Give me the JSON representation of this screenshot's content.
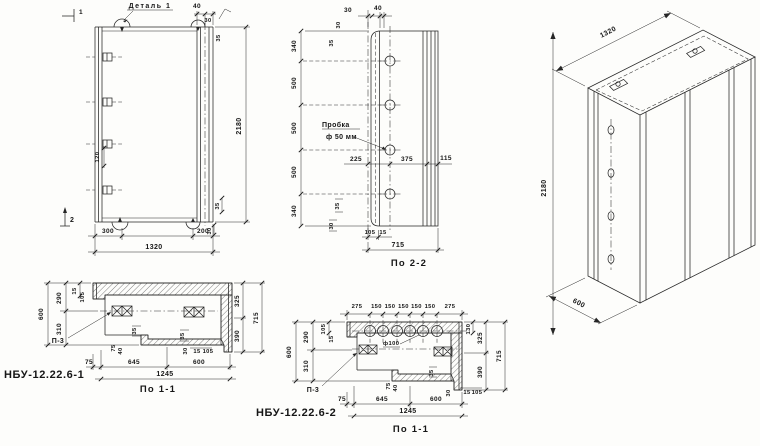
{
  "front_view": {
    "detail_label": "Деталь 1",
    "marker_1": "1",
    "marker_2": "2",
    "dims": {
      "top_40": "40",
      "top_30": "30",
      "top_35": "35",
      "height_2180": "2180",
      "hook_120": "120",
      "bot_300": "300",
      "bot_200": "200",
      "bot_1320": "1320",
      "br_30": "30",
      "br_35": "35"
    }
  },
  "section_2_2": {
    "caption": "По 2-2",
    "plug_label_line1": "Пробка",
    "plug_label_line2": "ф 50 мм",
    "dims": {
      "left": [
        "340",
        "500",
        "500",
        "500",
        "340"
      ],
      "top_30": "30",
      "top_40": "40",
      "side_30": "30",
      "side_35": "35",
      "mid_225": "225",
      "mid_375": "375",
      "mid_115": "115",
      "bl_35": "35",
      "bl_30": "30",
      "b_105": "105",
      "b_15": "15",
      "width_715": "715"
    }
  },
  "iso_view": {
    "dims": {
      "length_1320": "1320",
      "height_2180": "2180",
      "depth_600": "600"
    }
  },
  "section_1_1_a": {
    "title": "НБУ-12.22.6-1",
    "caption": "По 1-1",
    "anchor_label": "П-3",
    "dims": {
      "left_600": "600",
      "left_290": "290",
      "left_310": "310",
      "left_15": "15",
      "left_105": "105",
      "right_325": "325",
      "right_390": "390",
      "right_715": "715",
      "bot_75": "75",
      "bot_645": "645",
      "bot_600": "600",
      "bot_1245": "1245",
      "s_35a": "35",
      "s_35b": "35",
      "s_75": "75",
      "s_40": "40",
      "s_30": "30",
      "s_15": "15",
      "s_105": "105"
    }
  },
  "section_1_1_b": {
    "title": "НБУ-12.22.6-2",
    "caption": "По 1-1",
    "anchor_label": "П-3",
    "hole_label": "ф100",
    "dims": {
      "top": [
        "275",
        "150",
        "150",
        "150",
        "150",
        "150",
        "275"
      ],
      "left_600": "600",
      "left_290": "290",
      "left_310": "310",
      "left_105": "105",
      "left_15": "15",
      "right_130": "130",
      "right_325": "325",
      "right_390": "390",
      "right_715": "715",
      "bot_75": "75",
      "bot_645": "645",
      "bot_600": "600",
      "bot_1245": "1245",
      "s_35": "35",
      "s_75": "75",
      "s_40": "40",
      "s_30": "30",
      "s_15": "15",
      "s_105": "105"
    }
  }
}
